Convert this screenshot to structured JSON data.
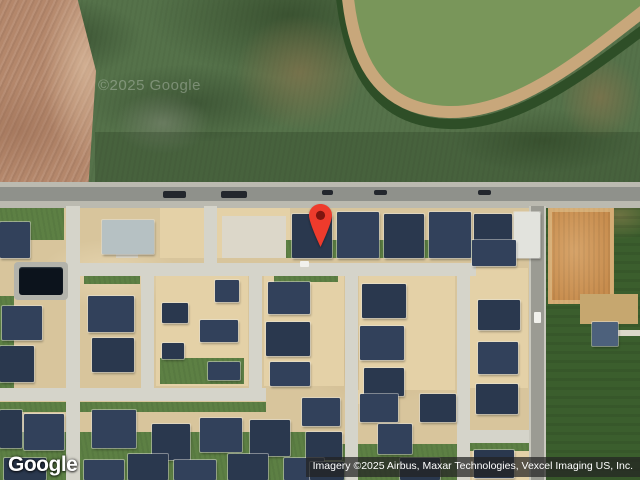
{
  "map": {
    "watermark": "©2025 Google",
    "logo": "Google",
    "attribution": "Imagery ©2025 Airbus, Maxar Technologies, Vexcel Imaging US, Inc.",
    "pin": {
      "color": "#EE3B2C",
      "inner_color": "#7E150F",
      "tip_x": 320,
      "tip_y": 249
    }
  },
  "palette": {
    "field_green": "#55724a",
    "field_brown": "#b4876b",
    "field_dark_green": "#3b5e2d",
    "dirt_tan": "#d8c59c",
    "dirt_orange": "#c78c4d",
    "road_asphalt": "#8f918b",
    "street_concrete": "#d5d4ca",
    "roof_dark": "#32415b",
    "pond": "#0c131c"
  },
  "features": {
    "layer_order": [
      "fields",
      "lots",
      "lawns",
      "roads",
      "streets",
      "pads",
      "houses",
      "vehicles",
      "water"
    ],
    "canal": {
      "inner_d": "M347,-12 C352,50 372,108 448,112 C520,115 592,52 652,8 L652,-12 Z",
      "shadow_d": "M340,-12 C346,58 369,122 449,124 C522,127 596,64 654,22",
      "track_d": "M347,-12 C352,52 374,110 448,112 C520,114 590,52 650,6"
    },
    "fields": [
      [
        0,
        0,
        640,
        188,
        "field-green"
      ],
      [
        0,
        0,
        96,
        187,
        "field-brown"
      ],
      [
        235,
        15,
        130,
        115,
        "scrub"
      ],
      [
        560,
        55,
        80,
        85,
        "scrub"
      ],
      [
        115,
        92,
        95,
        62,
        "scrub-gray"
      ],
      [
        95,
        132,
        545,
        54,
        "darken"
      ],
      [
        0,
        186,
        546,
        294,
        "base-tan"
      ],
      [
        546,
        186,
        94,
        294,
        "field-dark"
      ]
    ],
    "lots": [
      [
        160,
        208,
        130,
        50,
        "lot-bright"
      ],
      [
        156,
        274,
        92,
        112,
        "lot-bright"
      ],
      [
        264,
        274,
        80,
        112,
        "lot-bright"
      ],
      [
        359,
        270,
        96,
        120,
        "lot-bright"
      ],
      [
        470,
        268,
        58,
        120,
        "lot-bright"
      ],
      [
        472,
        448,
        60,
        32,
        "lot-bright"
      ],
      [
        352,
        390,
        24,
        14,
        "lot-bright"
      ],
      [
        516,
        446,
        26,
        34,
        "lot-bright"
      ],
      [
        548,
        208,
        66,
        96,
        "dirt-orange"
      ]
    ],
    "lawns": [
      [
        0,
        206,
        64,
        34,
        "lawn"
      ],
      [
        286,
        240,
        256,
        18,
        "lawn"
      ],
      [
        84,
        266,
        56,
        18,
        "lawn"
      ],
      [
        274,
        272,
        64,
        10,
        "lawn"
      ],
      [
        160,
        358,
        84,
        26,
        "lawn"
      ],
      [
        0,
        402,
        266,
        10,
        "lawn"
      ],
      [
        0,
        296,
        14,
        92,
        "lawn"
      ],
      [
        360,
        266,
        92,
        10,
        "lawn"
      ],
      [
        0,
        432,
        340,
        48,
        "lawn"
      ],
      [
        340,
        444,
        118,
        36,
        "lawn"
      ],
      [
        466,
        443,
        66,
        8,
        "lawn"
      ]
    ],
    "roads": [
      [
        0,
        182,
        640,
        26,
        "road-shoulder"
      ],
      [
        0,
        187,
        640,
        14,
        "road-asphalt"
      ]
    ],
    "streets": [
      [
        66,
        206,
        14,
        274,
        "street"
      ],
      [
        204,
        206,
        13,
        62,
        "street"
      ],
      [
        62,
        263,
        414,
        13,
        "street"
      ],
      [
        141,
        268,
        13,
        130,
        "street"
      ],
      [
        249,
        268,
        13,
        130,
        "street"
      ],
      [
        0,
        388,
        266,
        13,
        "street"
      ],
      [
        345,
        264,
        13,
        216,
        "street"
      ],
      [
        457,
        264,
        13,
        216,
        "street"
      ],
      [
        466,
        430,
        66,
        13,
        "street"
      ],
      [
        529,
        206,
        17,
        274,
        "street-gray"
      ]
    ],
    "pads": [
      [
        222,
        216,
        64,
        42,
        "pad"
      ],
      [
        116,
        252,
        22,
        6,
        "pad"
      ],
      [
        305,
        252,
        14,
        6,
        "pad"
      ],
      [
        350,
        252,
        14,
        6,
        "pad"
      ],
      [
        395,
        252,
        14,
        6,
        "pad"
      ],
      [
        440,
        252,
        14,
        6,
        "pad"
      ],
      [
        485,
        252,
        14,
        6,
        "pad"
      ],
      [
        580,
        294,
        58,
        30,
        "pad-tan"
      ],
      [
        618,
        330,
        22,
        6,
        "pad"
      ]
    ],
    "houses": [
      [
        0,
        222,
        30,
        36,
        "hd"
      ],
      [
        102,
        220,
        52,
        34,
        "hl"
      ],
      [
        292,
        214,
        40,
        44,
        "hd2"
      ],
      [
        337,
        212,
        42,
        46,
        "hd"
      ],
      [
        384,
        214,
        40,
        44,
        "hd2"
      ],
      [
        429,
        212,
        42,
        46,
        "hd"
      ],
      [
        474,
        214,
        38,
        44,
        "hd2"
      ],
      [
        514,
        212,
        26,
        46,
        "hw"
      ],
      [
        2,
        306,
        40,
        34,
        "hd"
      ],
      [
        0,
        346,
        34,
        36,
        "hd2"
      ],
      [
        88,
        296,
        46,
        36,
        "hd"
      ],
      [
        92,
        338,
        42,
        34,
        "hd2"
      ],
      [
        215,
        280,
        24,
        22,
        "hd"
      ],
      [
        162,
        303,
        26,
        20,
        "hd2"
      ],
      [
        200,
        320,
        38,
        22,
        "hd"
      ],
      [
        162,
        343,
        22,
        16,
        "hd2"
      ],
      [
        208,
        362,
        32,
        18,
        "hd"
      ],
      [
        268,
        282,
        42,
        32,
        "hd"
      ],
      [
        266,
        322,
        44,
        34,
        "hd2"
      ],
      [
        270,
        362,
        40,
        24,
        "hd"
      ],
      [
        362,
        284,
        44,
        34,
        "hd2"
      ],
      [
        360,
        326,
        44,
        34,
        "hd"
      ],
      [
        364,
        368,
        40,
        28,
        "hd2"
      ],
      [
        472,
        240,
        44,
        26,
        "hd"
      ],
      [
        478,
        300,
        42,
        30,
        "hd2"
      ],
      [
        478,
        342,
        40,
        32,
        "hd"
      ],
      [
        476,
        384,
        42,
        30,
        "hd2"
      ],
      [
        0,
        410,
        22,
        38,
        "hd2"
      ],
      [
        24,
        414,
        40,
        36,
        "hd"
      ],
      [
        92,
        410,
        44,
        38,
        "hd"
      ],
      [
        152,
        424,
        38,
        36,
        "hd2"
      ],
      [
        200,
        418,
        42,
        34,
        "hd"
      ],
      [
        250,
        420,
        40,
        36,
        "hd2"
      ],
      [
        302,
        398,
        38,
        28,
        "hd"
      ],
      [
        306,
        432,
        36,
        28,
        "hd2"
      ],
      [
        4,
        458,
        42,
        22,
        "hd2"
      ],
      [
        84,
        460,
        40,
        20,
        "hd"
      ],
      [
        128,
        454,
        40,
        26,
        "hd2"
      ],
      [
        174,
        460,
        42,
        20,
        "hd"
      ],
      [
        228,
        454,
        40,
        26,
        "hd2"
      ],
      [
        284,
        458,
        40,
        22,
        "hd"
      ],
      [
        310,
        462,
        34,
        18,
        "hd2"
      ],
      [
        360,
        394,
        38,
        28,
        "hd"
      ],
      [
        420,
        394,
        36,
        28,
        "hd2"
      ],
      [
        378,
        424,
        34,
        30,
        "hd"
      ],
      [
        400,
        458,
        40,
        22,
        "hd2"
      ],
      [
        474,
        450,
        40,
        28,
        "hd2"
      ],
      [
        592,
        322,
        26,
        24,
        "hm"
      ]
    ],
    "vehicles": [
      [
        163,
        191,
        23,
        7,
        "veh-dark"
      ],
      [
        221,
        191,
        26,
        7,
        "veh-dark"
      ],
      [
        322,
        190,
        11,
        5,
        "veh-dark"
      ],
      [
        374,
        190,
        13,
        5,
        "veh-dark"
      ],
      [
        478,
        190,
        13,
        5,
        "veh-dark"
      ],
      [
        300,
        261,
        9,
        6,
        "veh-white"
      ],
      [
        534,
        312,
        7,
        11,
        "veh-white"
      ]
    ],
    "water": [
      [
        14,
        262,
        54,
        38,
        "pond-frame"
      ],
      [
        19,
        267,
        44,
        28,
        "pond"
      ]
    ]
  }
}
